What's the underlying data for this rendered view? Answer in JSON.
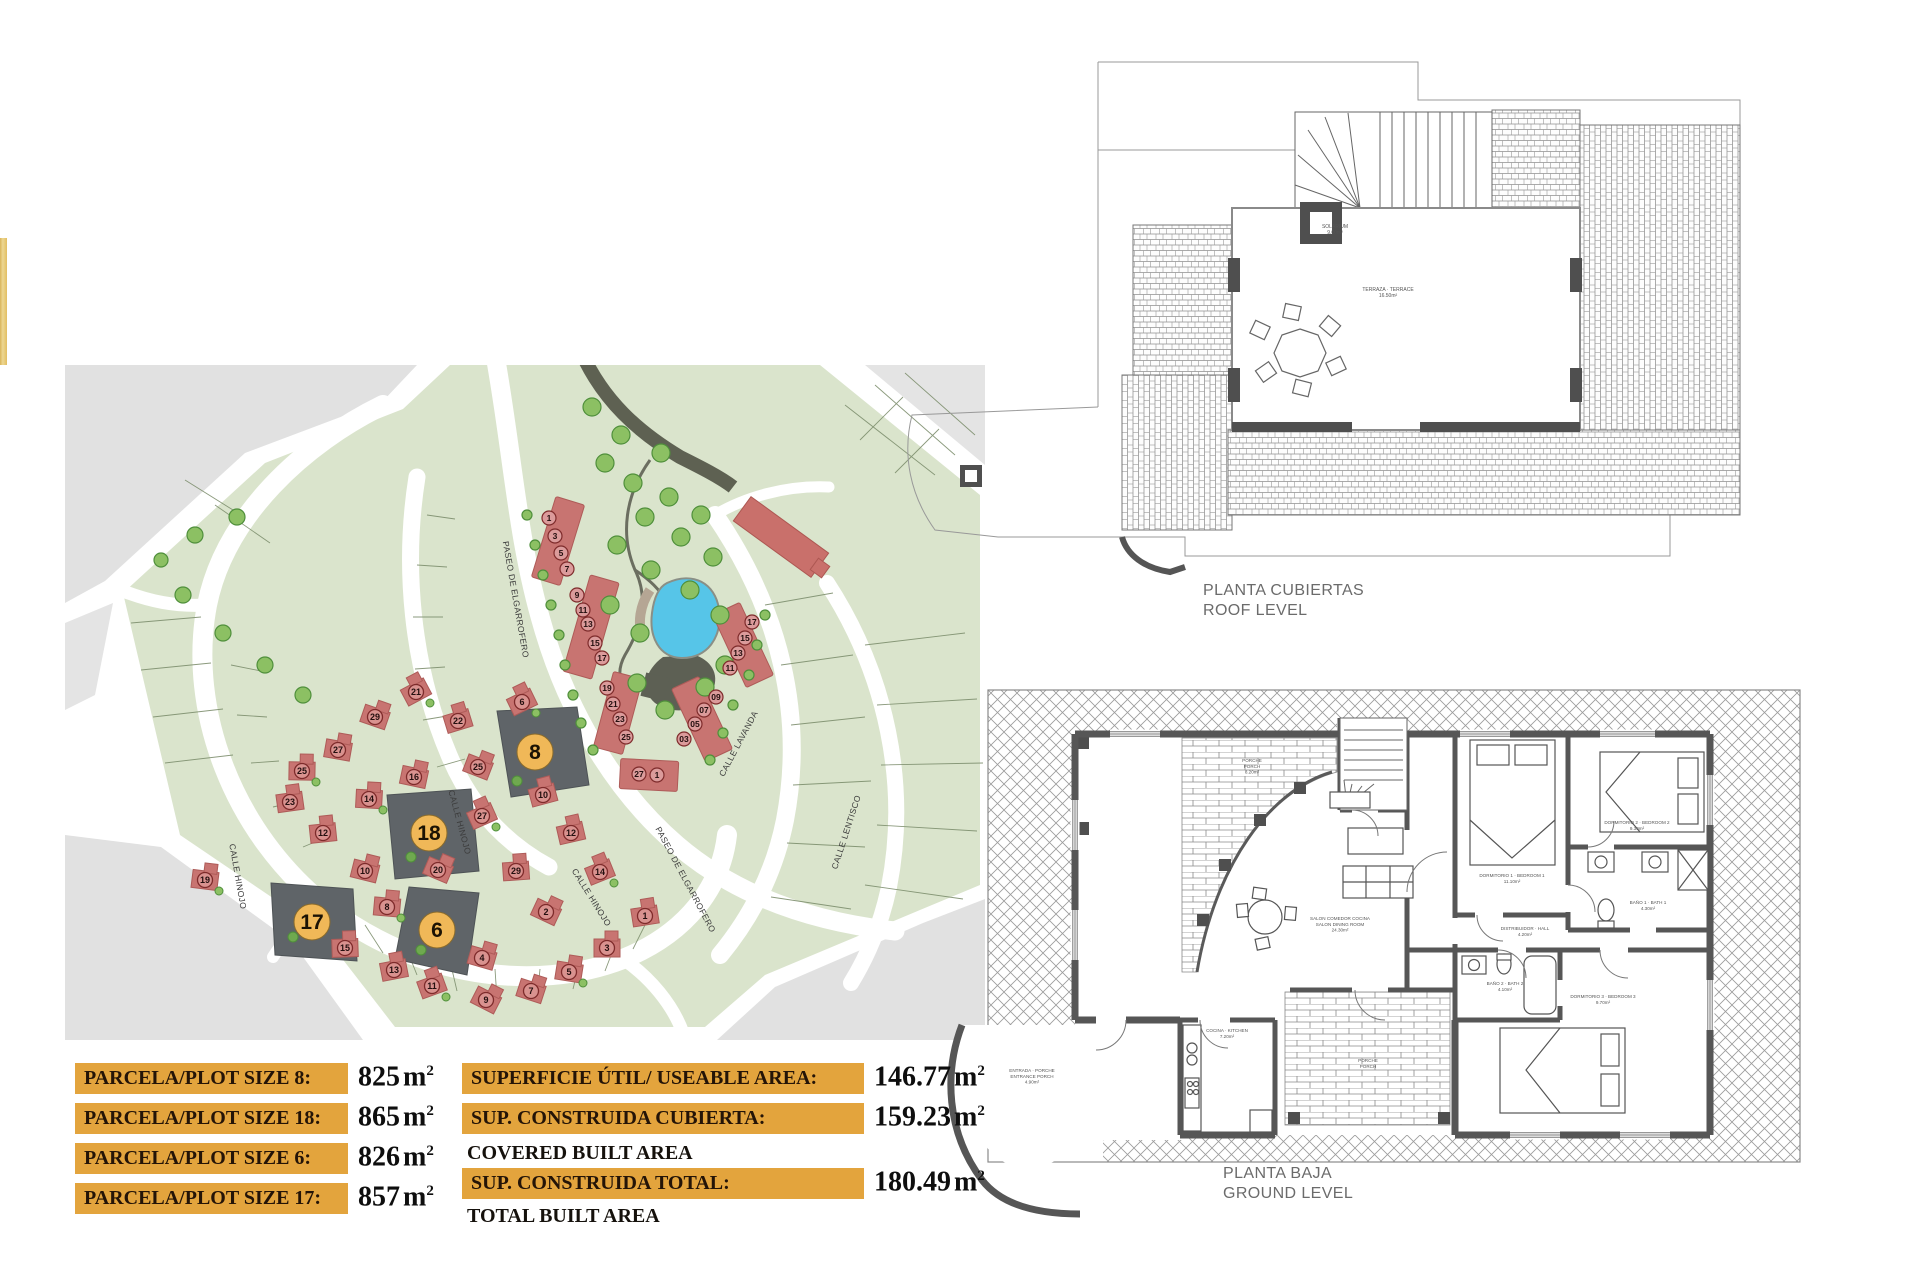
{
  "plan_titles": {
    "roof_es": "PLANTA CUBIERTAS",
    "roof_en": "ROOF LEVEL",
    "ground_es": "PLANTA BAJA",
    "ground_en": "GROUND LEVEL"
  },
  "colors": {
    "accent_orange": "#E3A43D",
    "plot_highlight_circle": "#F0B858",
    "plot_highlight_fill": "#5F6468",
    "house_red": "#C87471",
    "estate_green": "#DAE4CC",
    "road_gray": "#E1E1E1",
    "pool_blue": "#56C5E8",
    "wall_gray": "#565656"
  },
  "tables": {
    "unit_base": "m",
    "unit_sup": "2",
    "plot_sizes": {
      "rows": [
        {
          "label": "PARCELA/PLOT SIZE 8:",
          "value": "825"
        },
        {
          "label": "PARCELA/PLOT SIZE 18:",
          "value": "865"
        },
        {
          "label": "PARCELA/PLOT SIZE 6:",
          "value": "826"
        },
        {
          "label": "PARCELA/PLOT SIZE 17:",
          "value": "857"
        }
      ]
    },
    "areas": {
      "rows": [
        {
          "type": "bar",
          "label": "SUPERFICIE ÚTIL/ USEABLE AREA:",
          "value": "146.77"
        },
        {
          "type": "bar",
          "label": "SUP. CONSTRUIDA CUBIERTA:",
          "value": "159.23"
        },
        {
          "type": "plain",
          "label": "COVERED BUILT AREA"
        },
        {
          "type": "bar",
          "label": "SUP. CONSTRUIDA TOTAL:",
          "value": "180.49"
        },
        {
          "type": "plain",
          "label": "TOTAL BUILT AREA"
        }
      ]
    }
  },
  "site_plan": {
    "street_labels": [
      {
        "text": "CALLE HINOJO",
        "x": 170,
        "y": 512,
        "rot": 80
      },
      {
        "text": "CALLE HINOJO",
        "x": 392,
        "y": 458,
        "rot": 75
      },
      {
        "text": "CALLE HINOJO",
        "x": 524,
        "y": 534,
        "rot": 58
      },
      {
        "text": "PASEO DE ELGARROFERO",
        "x": 448,
        "y": 235,
        "rot": 80
      },
      {
        "text": "PASEO DE ELGARROFERO",
        "x": 618,
        "y": 516,
        "rot": 62
      },
      {
        "text": "CALLE LAVANDA",
        "x": 676,
        "y": 380,
        "rot": -62
      },
      {
        "text": "CALLE LENTISCO",
        "x": 784,
        "y": 468,
        "rot": -72
      }
    ],
    "highlighted_plots": [
      {
        "number": "8",
        "cx": 470,
        "cy": 387
      },
      {
        "number": "18",
        "cx": 364,
        "cy": 468
      },
      {
        "number": "6",
        "cx": 372,
        "cy": 565
      },
      {
        "number": "17",
        "cx": 247,
        "cy": 557
      }
    ],
    "townhouse_numbers": [
      {
        "n": "1",
        "x": 484,
        "y": 153
      },
      {
        "n": "3",
        "x": 490,
        "y": 171
      },
      {
        "n": "5",
        "x": 496,
        "y": 188
      },
      {
        "n": "7",
        "x": 502,
        "y": 204
      },
      {
        "n": "9",
        "x": 512,
        "y": 230
      },
      {
        "n": "11",
        "x": 518,
        "y": 245
      },
      {
        "n": "13",
        "x": 523,
        "y": 259
      },
      {
        "n": "15",
        "x": 530,
        "y": 278
      },
      {
        "n": "17",
        "x": 537,
        "y": 293
      },
      {
        "n": "19",
        "x": 542,
        "y": 323
      },
      {
        "n": "21",
        "x": 548,
        "y": 339
      },
      {
        "n": "23",
        "x": 555,
        "y": 354
      },
      {
        "n": "25",
        "x": 561,
        "y": 372
      },
      {
        "n": "27",
        "x": 574,
        "y": 409
      },
      {
        "n": "1",
        "x": 592,
        "y": 410
      },
      {
        "n": "17",
        "x": 687,
        "y": 257
      },
      {
        "n": "15",
        "x": 680,
        "y": 273
      },
      {
        "n": "13",
        "x": 673,
        "y": 288
      },
      {
        "n": "11",
        "x": 665,
        "y": 303
      },
      {
        "n": "09",
        "x": 651,
        "y": 332
      },
      {
        "n": "07",
        "x": 639,
        "y": 345
      },
      {
        "n": "05",
        "x": 630,
        "y": 359
      },
      {
        "n": "03",
        "x": 619,
        "y": 374
      }
    ],
    "detached_numbers": [
      {
        "n": "21",
        "x": 351,
        "y": 327
      },
      {
        "n": "29",
        "x": 310,
        "y": 352
      },
      {
        "n": "27",
        "x": 273,
        "y": 385
      },
      {
        "n": "25",
        "x": 237,
        "y": 406
      },
      {
        "n": "23",
        "x": 225,
        "y": 437
      },
      {
        "n": "22",
        "x": 393,
        "y": 356
      },
      {
        "n": "6",
        "x": 457,
        "y": 337
      },
      {
        "n": "25",
        "x": 413,
        "y": 402
      },
      {
        "n": "16",
        "x": 349,
        "y": 412
      },
      {
        "n": "14",
        "x": 304,
        "y": 434
      },
      {
        "n": "12",
        "x": 258,
        "y": 468
      },
      {
        "n": "10",
        "x": 478,
        "y": 430
      },
      {
        "n": "27",
        "x": 417,
        "y": 451
      },
      {
        "n": "20",
        "x": 373,
        "y": 505
      },
      {
        "n": "10",
        "x": 300,
        "y": 506
      },
      {
        "n": "8",
        "x": 322,
        "y": 542
      },
      {
        "n": "29",
        "x": 451,
        "y": 506
      },
      {
        "n": "12",
        "x": 506,
        "y": 468
      },
      {
        "n": "14",
        "x": 535,
        "y": 507
      },
      {
        "n": "2",
        "x": 481,
        "y": 547
      },
      {
        "n": "4",
        "x": 417,
        "y": 593
      },
      {
        "n": "19",
        "x": 140,
        "y": 515
      },
      {
        "n": "15",
        "x": 280,
        "y": 583
      },
      {
        "n": "13",
        "x": 329,
        "y": 605
      },
      {
        "n": "11",
        "x": 367,
        "y": 621
      },
      {
        "n": "9",
        "x": 421,
        "y": 635
      },
      {
        "n": "7",
        "x": 466,
        "y": 626
      },
      {
        "n": "5",
        "x": 504,
        "y": 607
      },
      {
        "n": "3",
        "x": 542,
        "y": 583
      },
      {
        "n": "1",
        "x": 580,
        "y": 551
      }
    ]
  },
  "roof_plan": {
    "tiny_labels": [
      {
        "x": 455,
        "y": 203,
        "lines": [
          "SOLARIUM",
          "9.00m²"
        ]
      },
      {
        "x": 508,
        "y": 266,
        "lines": [
          "TERRAZA · TERRACE",
          "16.50m²"
        ]
      }
    ]
  },
  "ground_plan": {
    "room_labels": [
      {
        "x": 352,
        "y": 82,
        "lines": [
          "PORCHE",
          "PORCH",
          "8.20m²"
        ]
      },
      {
        "x": 440,
        "y": 240,
        "lines": [
          "SALON COMEDOR COCINA",
          "SALON DINING ROOM",
          "24.30m²"
        ]
      },
      {
        "x": 625,
        "y": 250,
        "lines": [
          "DISTRIBUIDOR · HALL",
          "4.20m²"
        ]
      },
      {
        "x": 612,
        "y": 197,
        "lines": [
          "DORMITORIO 1 · BEDROOM 1",
          "11.10m²"
        ]
      },
      {
        "x": 737,
        "y": 144,
        "lines": [
          "DORMITORIO 2 · BEDROOM 2",
          "9.30m²"
        ]
      },
      {
        "x": 748,
        "y": 224,
        "lines": [
          "BAÑO 1 · BATH 1",
          "4.30m²"
        ]
      },
      {
        "x": 605,
        "y": 305,
        "lines": [
          "BAÑO 2 · BATH 2",
          "4.10m²"
        ]
      },
      {
        "x": 703,
        "y": 318,
        "lines": [
          "DORMITORIO 3 · BEDROOM 3",
          "9.70m²"
        ]
      },
      {
        "x": 327,
        "y": 352,
        "lines": [
          "COCINA · KITCHEN",
          "7.20m²"
        ]
      },
      {
        "x": 132,
        "y": 392,
        "lines": [
          "ENTRADA · PORCHE",
          "ENTRANCE PORCH",
          "4.90m²"
        ]
      },
      {
        "x": 468,
        "y": 382,
        "lines": [
          "PORCHE",
          "PORCH"
        ]
      }
    ]
  }
}
